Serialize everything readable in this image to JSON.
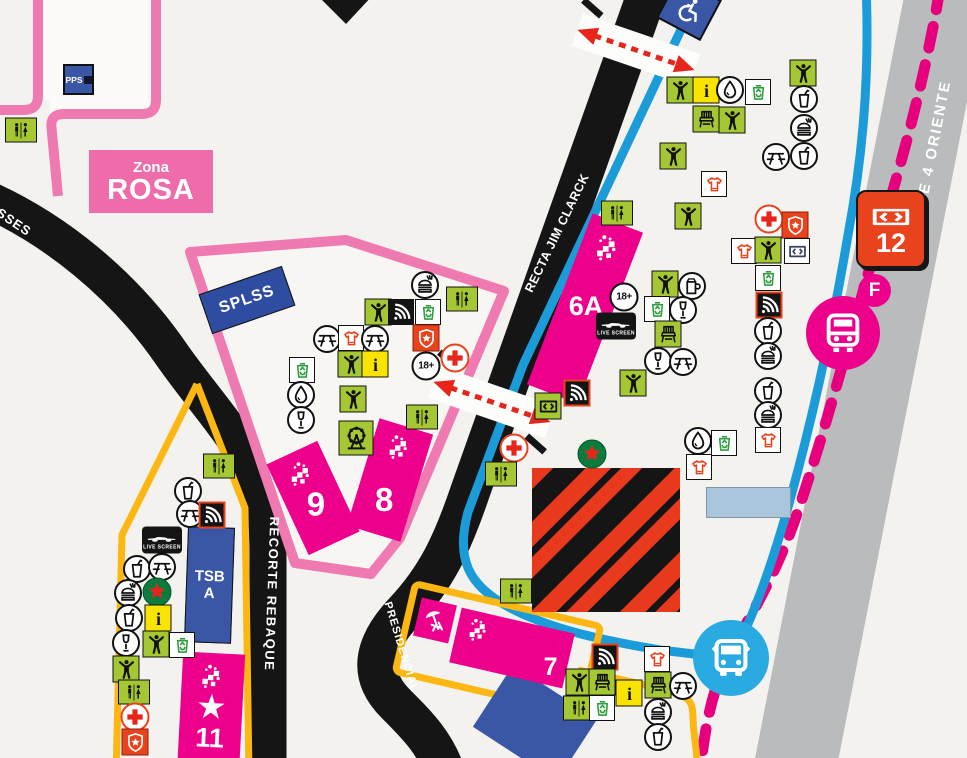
{
  "labels": {
    "pps": "PPS",
    "zona_line1": "Zona",
    "zona_line2": "ROSA",
    "splss": "SPLSS",
    "tsb_line1": "TSB",
    "tsb_line2": "A",
    "live_screen": "LIVE SCREEN",
    "age_badge": "18+",
    "star_glyph": "★"
  },
  "roads": {
    "esses_partial": "SSES",
    "recta_jim_clarck": "RECTA JIM CLARCK",
    "recorte_rebaque": "RECORTE REBAQUE",
    "presidencial": "PRESIDENCIAL",
    "eje_4": "EJE 4 ORIENTE"
  },
  "stands": {
    "s6a": "6A",
    "s7": "7",
    "s8": "8",
    "s9": "9",
    "s11": "11"
  },
  "gate": {
    "number": "12"
  },
  "transit": {
    "station_letter": "F"
  },
  "colors": {
    "magenta": "#ec008c",
    "pink_outline": "#ef79b1",
    "dashed_pink": "#e6007e",
    "blue_route": "#1b9cd9",
    "bus_blue": "#29abe2",
    "dark_blue": "#3a57a6",
    "icon_green": "#a4c733",
    "yellow_path": "#fcb713",
    "info_yellow": "#f9e300",
    "alert_red": "#e8431c",
    "road_black": "#1a1a1a",
    "gray_road": "#b9bbbd",
    "bg": "#f4f2ee"
  },
  "icons": [
    {
      "t": "wc",
      "x": 21,
      "y": 130
    },
    {
      "t": "burger",
      "x": 425,
      "y": 285
    },
    {
      "t": "person",
      "x": 378,
      "y": 312
    },
    {
      "t": "signal",
      "x": 401,
      "y": 312
    },
    {
      "t": "recycle",
      "x": 428,
      "y": 312
    },
    {
      "t": "wc",
      "x": 462,
      "y": 299
    },
    {
      "t": "picnic",
      "x": 327,
      "y": 339
    },
    {
      "t": "shirt",
      "x": 351,
      "y": 338
    },
    {
      "t": "picnic",
      "x": 375,
      "y": 339
    },
    {
      "t": "shield",
      "x": 426,
      "y": 338
    },
    {
      "t": "person",
      "x": 351,
      "y": 364
    },
    {
      "t": "info",
      "x": 375,
      "y": 364
    },
    {
      "t": "age18",
      "x": 426,
      "y": 366
    },
    {
      "t": "cross",
      "x": 455,
      "y": 358
    },
    {
      "t": "recycle",
      "x": 302,
      "y": 370
    },
    {
      "t": "drop",
      "x": 301,
      "y": 395
    },
    {
      "t": "wine",
      "x": 301,
      "y": 420
    },
    {
      "t": "person",
      "x": 353,
      "y": 399
    },
    {
      "t": "ferris",
      "x": 356,
      "y": 438
    },
    {
      "t": "wc",
      "x": 422,
      "y": 417
    },
    {
      "t": "wc",
      "x": 617,
      "y": 213
    },
    {
      "t": "cross",
      "x": 514,
      "y": 448
    },
    {
      "t": "wc",
      "x": 501,
      "y": 474
    },
    {
      "t": "wc",
      "x": 516,
      "y": 591
    },
    {
      "t": "ticket_green",
      "x": 548,
      "y": 406
    },
    {
      "t": "signal_red",
      "x": 577,
      "y": 393
    },
    {
      "t": "age18",
      "x": 624,
      "y": 297
    },
    {
      "t": "livescreen",
      "x": 616,
      "y": 326
    },
    {
      "t": "person",
      "x": 665,
      "y": 284
    },
    {
      "t": "mug",
      "x": 692,
      "y": 286
    },
    {
      "t": "recycle",
      "x": 657,
      "y": 309
    },
    {
      "t": "wine",
      "x": 683,
      "y": 310
    },
    {
      "t": "chair",
      "x": 668,
      "y": 334
    },
    {
      "t": "wine",
      "x": 658,
      "y": 361
    },
    {
      "t": "picnic",
      "x": 683,
      "y": 362
    },
    {
      "t": "person",
      "x": 633,
      "y": 383
    },
    {
      "t": "person",
      "x": 680,
      "y": 90
    },
    {
      "t": "info",
      "x": 706,
      "y": 90
    },
    {
      "t": "drop",
      "x": 730,
      "y": 90
    },
    {
      "t": "recycle",
      "x": 758,
      "y": 92
    },
    {
      "t": "chair",
      "x": 706,
      "y": 119
    },
    {
      "t": "person",
      "x": 732,
      "y": 120
    },
    {
      "t": "person",
      "x": 803,
      "y": 73
    },
    {
      "t": "cup",
      "x": 804,
      "y": 99
    },
    {
      "t": "burger",
      "x": 804,
      "y": 128
    },
    {
      "t": "picnic",
      "x": 776,
      "y": 157
    },
    {
      "t": "cup",
      "x": 804,
      "y": 156
    },
    {
      "t": "person",
      "x": 673,
      "y": 156
    },
    {
      "t": "shirt",
      "x": 714,
      "y": 184
    },
    {
      "t": "person",
      "x": 688,
      "y": 216
    },
    {
      "t": "cross",
      "x": 769,
      "y": 219
    },
    {
      "t": "shield",
      "x": 795,
      "y": 225
    },
    {
      "t": "shirt",
      "x": 744,
      "y": 251
    },
    {
      "t": "person",
      "x": 768,
      "y": 250
    },
    {
      "t": "ticket_white",
      "x": 797,
      "y": 251
    },
    {
      "t": "recycle",
      "x": 768,
      "y": 278
    },
    {
      "t": "signal_red",
      "x": 769,
      "y": 305
    },
    {
      "t": "cup",
      "x": 768,
      "y": 331
    },
    {
      "t": "burger",
      "x": 768,
      "y": 356
    },
    {
      "t": "cup",
      "x": 768,
      "y": 391
    },
    {
      "t": "burger",
      "x": 768,
      "y": 415
    },
    {
      "t": "drop",
      "x": 698,
      "y": 441
    },
    {
      "t": "recycle",
      "x": 724,
      "y": 443
    },
    {
      "t": "shirt",
      "x": 768,
      "y": 440
    },
    {
      "t": "shirt",
      "x": 699,
      "y": 467
    },
    {
      "t": "heineken",
      "x": 592,
      "y": 454
    },
    {
      "t": "wc",
      "x": 219,
      "y": 466
    },
    {
      "t": "cup",
      "x": 188,
      "y": 491
    },
    {
      "t": "picnic",
      "x": 190,
      "y": 514
    },
    {
      "t": "signal_red",
      "x": 212,
      "y": 515
    },
    {
      "t": "livescreen",
      "x": 162,
      "y": 540
    },
    {
      "t": "cup",
      "x": 137,
      "y": 569
    },
    {
      "t": "picnic",
      "x": 162,
      "y": 567
    },
    {
      "t": "burger",
      "x": 128,
      "y": 593
    },
    {
      "t": "heineken",
      "x": 157,
      "y": 592
    },
    {
      "t": "cup",
      "x": 129,
      "y": 618
    },
    {
      "t": "info",
      "x": 158,
      "y": 618
    },
    {
      "t": "wine",
      "x": 126,
      "y": 643
    },
    {
      "t": "person",
      "x": 156,
      "y": 644
    },
    {
      "t": "recycle",
      "x": 182,
      "y": 645
    },
    {
      "t": "person",
      "x": 126,
      "y": 669
    },
    {
      "t": "wc",
      "x": 134,
      "y": 692
    },
    {
      "t": "cross",
      "x": 135,
      "y": 717
    },
    {
      "t": "shield",
      "x": 135,
      "y": 742
    },
    {
      "t": "signal_red",
      "x": 605,
      "y": 657
    },
    {
      "t": "person",
      "x": 579,
      "y": 682
    },
    {
      "t": "chair",
      "x": 602,
      "y": 682
    },
    {
      "t": "wc",
      "x": 579,
      "y": 708
    },
    {
      "t": "recycle",
      "x": 602,
      "y": 708
    },
    {
      "t": "info",
      "x": 629,
      "y": 693
    },
    {
      "t": "shirt",
      "x": 657,
      "y": 659
    },
    {
      "t": "chair",
      "x": 658,
      "y": 685
    },
    {
      "t": "picnic",
      "x": 683,
      "y": 686
    },
    {
      "t": "burger",
      "x": 658,
      "y": 712
    },
    {
      "t": "cup",
      "x": 658,
      "y": 737
    }
  ]
}
